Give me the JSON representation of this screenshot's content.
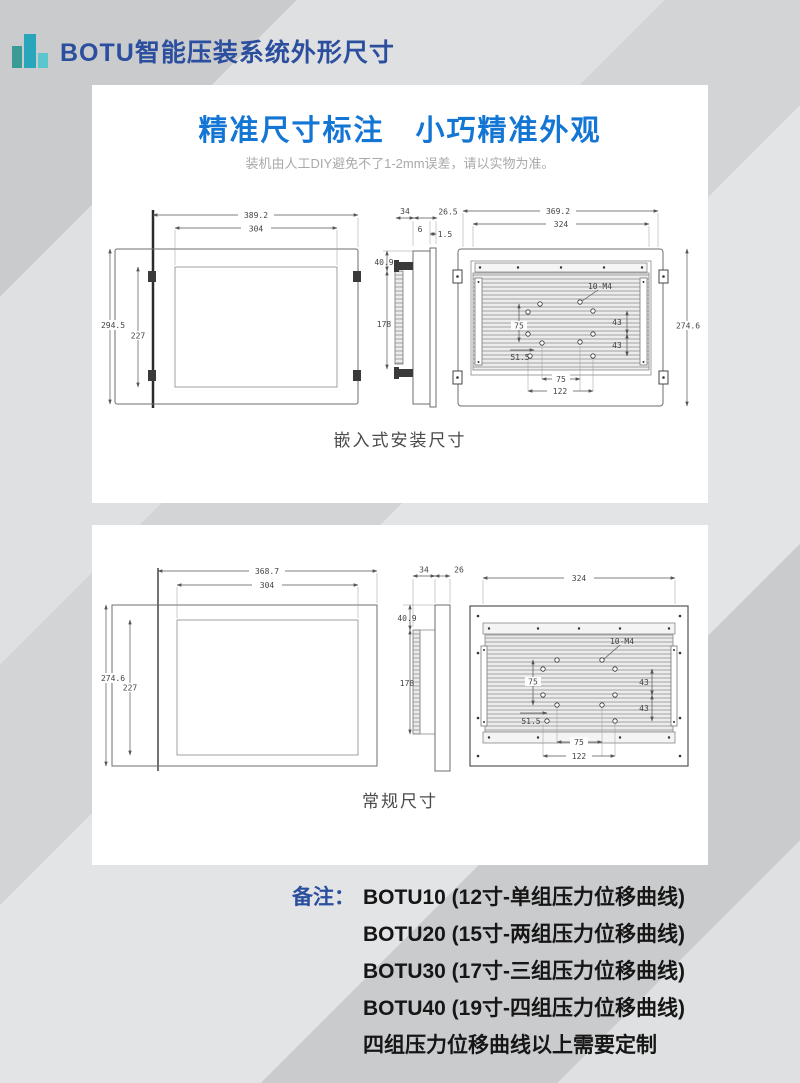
{
  "header": {
    "title": "BOTU智能压装系统外形尺寸",
    "logo_icon": "bar-chart-logo"
  },
  "colors": {
    "accent_blue": "#1476d4",
    "header_blue": "#2b4f9e",
    "logo_teal_dark": "#3a9a96",
    "logo_teal": "#2aa6bc",
    "logo_teal_light": "#5cc6cf"
  },
  "card1": {
    "title": "精准尺寸标注　小巧精准外观",
    "subtitle": "装机由人工DIY避免不了1-2mm误差，请以实物为准。",
    "caption": "嵌入式安装尺寸",
    "dims": {
      "front_width": "389.2",
      "screen_width": "304",
      "front_height": "294.5",
      "screen_height": "227",
      "depth_total": "34",
      "depth_front": "26.5",
      "depth_a": "6",
      "depth_b": "1.5",
      "side_offset": "40.9",
      "side_span": "178",
      "back_width": "369.2",
      "back_inner_width": "324",
      "back_height": "274.6",
      "holes": "10-M4",
      "hole_v": "75",
      "hole_r1": "43",
      "hole_r2": "43",
      "hole_off": "51.5",
      "hole_h": "75",
      "hole_h2": "122"
    }
  },
  "card2": {
    "caption": "常规尺寸",
    "dims": {
      "front_width": "368.7",
      "screen_width": "304",
      "front_height": "274.6",
      "screen_height": "227",
      "depth_total": "34",
      "depth_front": "26",
      "side_offset": "40.9",
      "side_span": "178",
      "back_width": "324",
      "holes": "10-M4",
      "hole_v": "75",
      "hole_r1": "43",
      "hole_r2": "43",
      "hole_off": "51.5",
      "hole_h": "75",
      "hole_h2": "122"
    }
  },
  "notes": {
    "label": "备注：",
    "lines": [
      "BOTU10 (12寸-单组压力位移曲线)",
      "BOTU20 (15寸-两组压力位移曲线)",
      "BOTU30 (17寸-三组压力位移曲线)",
      "BOTU40 (19寸-四组压力位移曲线)",
      "四组压力位移曲线以上需要定制"
    ]
  }
}
